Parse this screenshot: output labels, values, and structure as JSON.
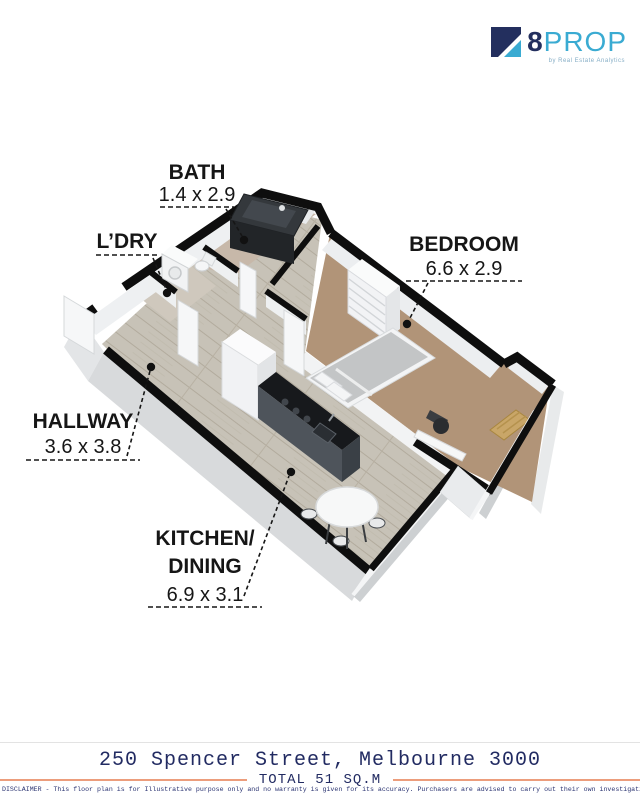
{
  "logo": {
    "name8": "8",
    "nameProp": "PROP",
    "tagline": "by Real Estate Analytics",
    "navy": "#232f5e",
    "cyan": "#3aabd2"
  },
  "labels": {
    "bath": {
      "name": "BATH",
      "dims": "1.4 x 2.9"
    },
    "ldry": {
      "name": "L’DRY"
    },
    "bedroom": {
      "name": "BEDROOM",
      "dims": "6.6 x 2.9"
    },
    "hallway": {
      "name": "HALLWAY",
      "dims": "3.6 x 3.8"
    },
    "kitchen": {
      "name": "KITCHEN/",
      "name2": "DINING",
      "dims": "6.9 x 3.1"
    }
  },
  "footer": {
    "address": "250 Spencer Street, Melbourne 3000",
    "total": "TOTAL 51 SQ.M",
    "disclaimer": "DISCLAIMER - This floor plan is for Illustrative purpose only and no warranty is given for its accuracy. Purchasers are advised to carry out their own investigation.",
    "accent_line_color": "#ec9d7c",
    "text_color": "#222b62"
  }
}
